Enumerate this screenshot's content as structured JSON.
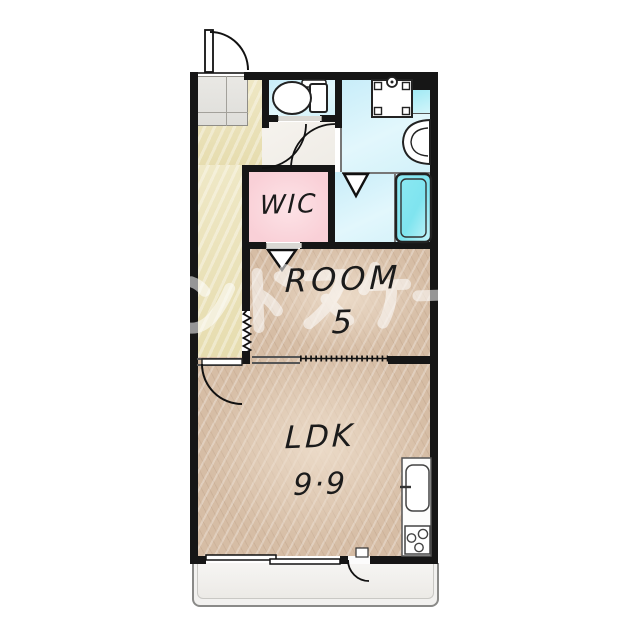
{
  "watermark": {
    "text": "ンドスケー"
  },
  "rooms": {
    "wic": {
      "label": "WIC"
    },
    "bedroom": {
      "label": "ROOM",
      "size": "5"
    },
    "ldk": {
      "label": "LDK",
      "size": "9·9"
    }
  },
  "fixtures": {
    "toilet": "toilet",
    "washer_pan": "washing-machine-pan",
    "basin": "wash-basin",
    "bathtub": "bathtub",
    "kitchen_sink": "kitchen-sink",
    "stove": "gas-stove",
    "entrance_door": "entrance-swing-door",
    "hall_door": "hallway-swing-door",
    "balcony_door": "balcony-swing-door",
    "sliding_window": "sliding-window",
    "folding_door": "accordion-folding-door"
  },
  "colors": {
    "wall": "#161616",
    "hallway_floor": "#ebe3bc",
    "wet_floor": "#d7f1f9",
    "bathtub": "#84e8f2",
    "wic_floor": "#fbd8dd",
    "wood_floor": "#d6bda5",
    "balcony_floor": "#f1f0ee",
    "watermark": "#ffffff"
  }
}
